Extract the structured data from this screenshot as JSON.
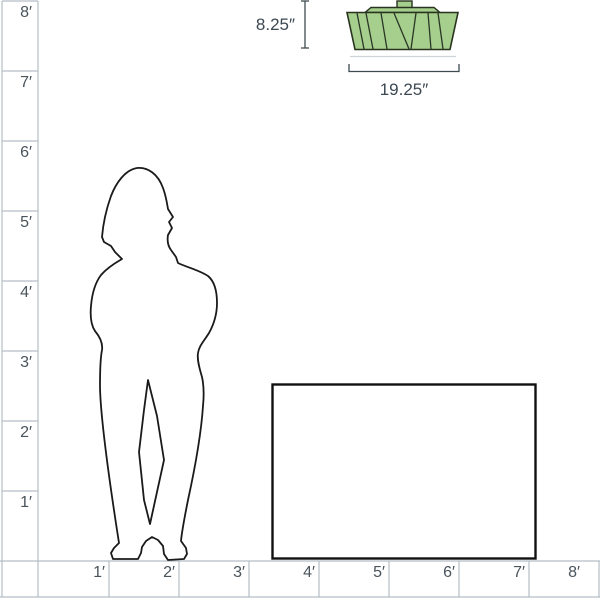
{
  "diagram": {
    "description": "product scale diagram with human figure and table for reference"
  },
  "dimensions": {
    "fixture_height": "8.25″",
    "fixture_width": "19.25″"
  },
  "rulers": {
    "left": {
      "unit": "feet",
      "labels": [
        "8′",
        "7′",
        "6′",
        "5′",
        "4′",
        "3′",
        "2′",
        "1′"
      ]
    },
    "bottom": {
      "unit": "feet",
      "labels": [
        "1′",
        "2′",
        "3′",
        "4′",
        "5′",
        "6′",
        "7′",
        "8′"
      ]
    }
  },
  "colors": {
    "grid_line": "#b5bec5",
    "ruler_label": "#4a545c",
    "dimension_text": "#3c4852",
    "fixture_fill": "#a6ce8c",
    "fixture_stroke": "#28341f",
    "silhouette_outline": "#1a1a1a"
  }
}
